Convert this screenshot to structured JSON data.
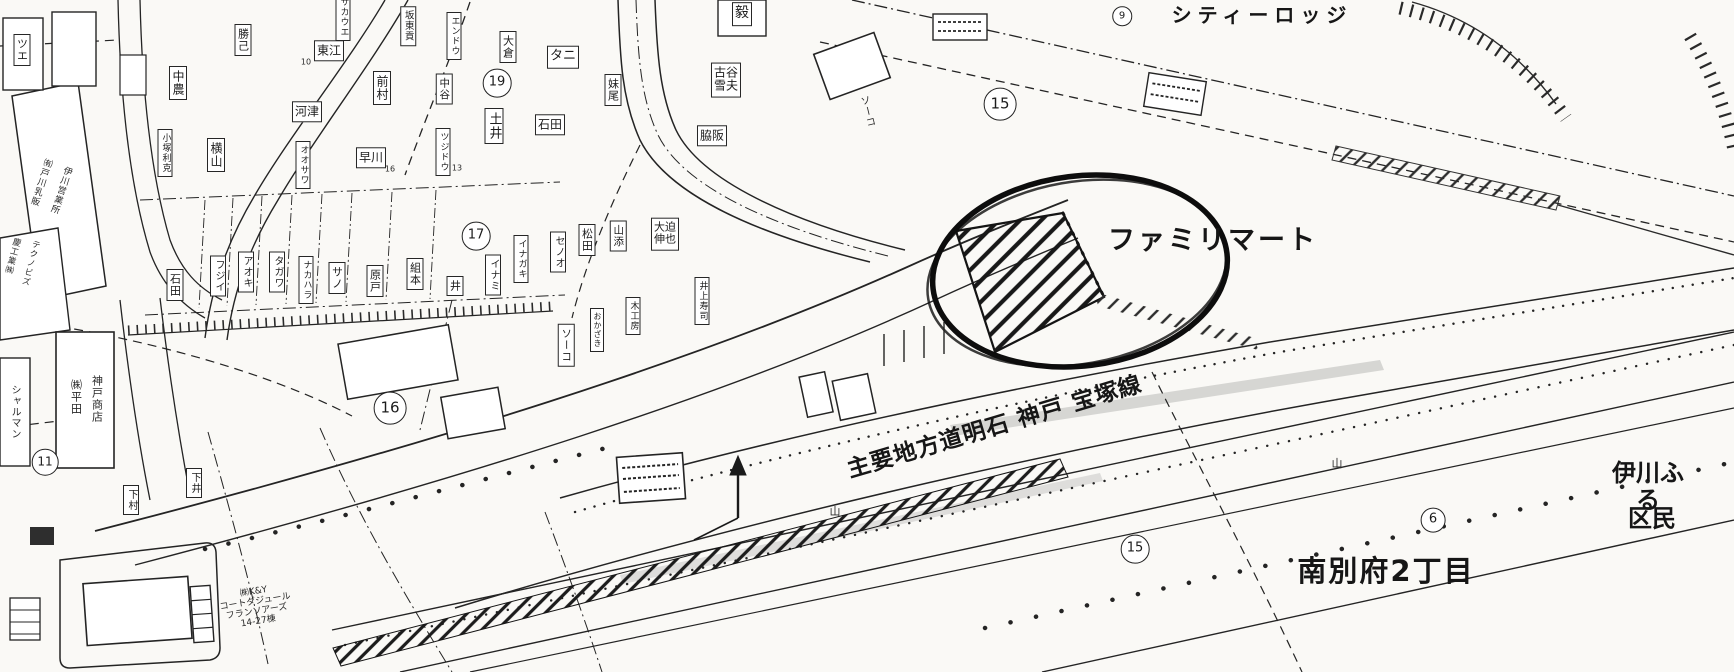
{
  "map": {
    "highlighted_store": "ファミリマート",
    "road_name": "主要地方道明石 神戸 宝塚線",
    "district": "南別府2丁目",
    "ink_color": "#242424",
    "paper_color": "#faf9f6",
    "labels": [
      {
        "t": "ファミリマート",
        "x": 1213,
        "y": 241,
        "k": "a",
        "s": 27,
        "ls": 3,
        "n": "familymart-label"
      },
      {
        "t": "主要地方道明石 神戸 宝塚線",
        "x": 995,
        "y": 428,
        "k": "a",
        "s": 23,
        "r": -16.5,
        "ls": 1,
        "n": "road-name-label"
      },
      {
        "t": "南別府2丁目",
        "x": 1386,
        "y": 571,
        "k": "a",
        "s": 29,
        "ls": 2,
        "n": "district-label"
      },
      {
        "t": "シティーロッジ",
        "x": 1262,
        "y": 15,
        "k": "a",
        "s": 20,
        "ls": 6,
        "n": "city-lodge-label"
      },
      {
        "t": "伊川ふる",
        "x": 1648,
        "y": 487,
        "k": "a",
        "s": 24,
        "n": "ikawa-furusato-label"
      },
      {
        "t": "区民",
        "x": 1652,
        "y": 519,
        "k": "a",
        "s": 24,
        "n": "kumin-label"
      },
      {
        "t": "19",
        "x": 497,
        "y": 83,
        "k": "c",
        "s": 13
      },
      {
        "t": "17",
        "x": 476,
        "y": 236,
        "k": "c",
        "s": 13
      },
      {
        "t": "16",
        "x": 390,
        "y": 408,
        "k": "c",
        "s": 15
      },
      {
        "t": "15",
        "x": 1000,
        "y": 104,
        "k": "c",
        "s": 15
      },
      {
        "t": "15",
        "x": 1135,
        "y": 549,
        "k": "c",
        "s": 13
      },
      {
        "t": "11",
        "x": 45,
        "y": 462,
        "k": "c",
        "s": 12
      },
      {
        "t": "6",
        "x": 1433,
        "y": 520,
        "k": "c",
        "s": 13
      },
      {
        "t": "9",
        "x": 1122,
        "y": 16,
        "k": "c",
        "s": 10
      },
      {
        "t": "中農",
        "x": 178,
        "y": 83,
        "k": "b",
        "m": "v",
        "s": 12
      },
      {
        "t": "勝己",
        "x": 243,
        "y": 40,
        "k": "b",
        "m": "v",
        "s": 11
      },
      {
        "t": "横山",
        "x": 216,
        "y": 155,
        "k": "b",
        "m": "v",
        "s": 12
      },
      {
        "t": "小塚利克",
        "x": 165,
        "y": 153,
        "k": "b",
        "m": "v",
        "s": 9
      },
      {
        "t": "河津",
        "x": 307,
        "y": 112,
        "k": "b",
        "s": 12
      },
      {
        "t": "オオサワ",
        "x": 303,
        "y": 165,
        "k": "b",
        "m": "v",
        "s": 9
      },
      {
        "t": "早川",
        "x": 371,
        "y": 158,
        "k": "b",
        "s": 12
      },
      {
        "t": "前村",
        "x": 382,
        "y": 88,
        "k": "b",
        "m": "v",
        "s": 12
      },
      {
        "t": "東江",
        "x": 329,
        "y": 51,
        "k": "b",
        "s": 12
      },
      {
        "t": "サカウエ",
        "x": 343,
        "y": 17,
        "k": "b",
        "m": "v",
        "s": 9
      },
      {
        "t": "坂東貢",
        "x": 408,
        "y": 26,
        "k": "b",
        "m": "v",
        "s": 9.5
      },
      {
        "t": "エンドウ",
        "x": 454,
        "y": 36,
        "k": "b",
        "m": "v",
        "s": 9
      },
      {
        "t": "中谷",
        "x": 444,
        "y": 89,
        "k": "b",
        "m": "v",
        "s": 10.5
      },
      {
        "t": "大倉",
        "x": 508,
        "y": 47,
        "k": "b",
        "m": "v",
        "s": 11
      },
      {
        "t": "タニ",
        "x": 563,
        "y": 57,
        "k": "b",
        "s": 13
      },
      {
        "t": "妹尾",
        "x": 613,
        "y": 90,
        "k": "b",
        "m": "v",
        "s": 11
      },
      {
        "t": "土井",
        "x": 494,
        "y": 126,
        "k": "b",
        "m": "v",
        "s": 13
      },
      {
        "t": "石田",
        "x": 550,
        "y": 125,
        "k": "b",
        "s": 12
      },
      {
        "t": "ツジドウ",
        "x": 443,
        "y": 152,
        "k": "b",
        "m": "v",
        "s": 9
      },
      {
        "t": "古谷\n雪夫",
        "x": 726,
        "y": 80,
        "k": "b",
        "s": 12
      },
      {
        "t": "脇阪",
        "x": 712,
        "y": 136,
        "k": "b",
        "s": 12
      },
      {
        "t": "石田",
        "x": 175,
        "y": 285,
        "k": "b",
        "m": "v",
        "s": 11
      },
      {
        "t": "フジイ",
        "x": 218,
        "y": 276,
        "k": "b",
        "m": "v",
        "s": 10
      },
      {
        "t": "アオキ",
        "x": 246,
        "y": 272,
        "k": "b",
        "m": "v",
        "s": 10
      },
      {
        "t": "タガワ",
        "x": 277,
        "y": 272,
        "k": "b",
        "m": "v",
        "s": 10
      },
      {
        "t": "ナカハラ",
        "x": 306,
        "y": 280,
        "k": "b",
        "m": "v",
        "s": 9
      },
      {
        "t": "サノ",
        "x": 337,
        "y": 278,
        "k": "b",
        "m": "v",
        "s": 11
      },
      {
        "t": "原戸",
        "x": 375,
        "y": 281,
        "k": "b",
        "m": "v",
        "s": 11
      },
      {
        "t": "組本",
        "x": 415,
        "y": 274,
        "k": "b",
        "m": "v",
        "s": 11
      },
      {
        "t": "井",
        "x": 455,
        "y": 286,
        "k": "b",
        "m": "v",
        "s": 11
      },
      {
        "t": "イナミ",
        "x": 493,
        "y": 275,
        "k": "b",
        "m": "v",
        "s": 10
      },
      {
        "t": "イナガキ",
        "x": 521,
        "y": 259,
        "k": "b",
        "m": "v",
        "s": 9
      },
      {
        "t": "セノオ",
        "x": 558,
        "y": 252,
        "k": "b",
        "m": "v",
        "s": 10
      },
      {
        "t": "松田",
        "x": 587,
        "y": 240,
        "k": "b",
        "m": "v",
        "s": 11
      },
      {
        "t": "山添",
        "x": 618,
        "y": 236,
        "k": "b",
        "m": "v",
        "s": 10.5
      },
      {
        "t": "大迫\n伸也",
        "x": 665,
        "y": 234,
        "k": "b",
        "s": 11
      },
      {
        "t": "井上寿司",
        "x": 702,
        "y": 301,
        "k": "b",
        "m": "v",
        "s": 9
      },
      {
        "t": "木工房",
        "x": 633,
        "y": 316,
        "k": "b",
        "m": "v",
        "s": 9
      },
      {
        "t": "ソーコ",
        "x": 566,
        "y": 345,
        "k": "b",
        "m": "v",
        "s": 10.5
      },
      {
        "t": "おかざき",
        "x": 597,
        "y": 330,
        "k": "b",
        "m": "v",
        "s": 8
      },
      {
        "t": "ソーコ",
        "x": 866,
        "y": 112,
        "k": "p",
        "m": "v",
        "s": 10,
        "r": -14
      },
      {
        "t": "㈱平田",
        "x": 76,
        "y": 397,
        "k": "p",
        "m": "v",
        "s": 11
      },
      {
        "t": "神戸商店",
        "x": 97,
        "y": 399,
        "k": "p",
        "m": "v",
        "s": 11
      },
      {
        "t": "シャルマン",
        "x": 14,
        "y": 412,
        "k": "p",
        "m": "v",
        "s": 10
      },
      {
        "t": "下村",
        "x": 131,
        "y": 500,
        "k": "b",
        "m": "v",
        "s": 10
      },
      {
        "t": "下井",
        "x": 194,
        "y": 483,
        "k": "b",
        "m": "v",
        "s": 10
      },
      {
        "t": "㈲戸川乳販",
        "x": 40,
        "y": 182,
        "k": "p",
        "m": "v",
        "s": 9,
        "r": 18
      },
      {
        "t": "伊川営業所",
        "x": 60,
        "y": 190,
        "k": "p",
        "m": "v",
        "s": 9,
        "r": 18
      },
      {
        "t": "慶工業㈱",
        "x": 12,
        "y": 256,
        "k": "p",
        "m": "v",
        "s": 8.5,
        "r": 15
      },
      {
        "t": "テクノビズ",
        "x": 30,
        "y": 263,
        "k": "p",
        "m": "v",
        "s": 8.5,
        "r": 15
      },
      {
        "t": "㈱K&Y\nコートダジュール\nフランソアーズ\n14-27棟",
        "x": 256,
        "y": 607,
        "k": "p",
        "s": 9,
        "r": -9
      },
      {
        "t": "ツエ",
        "x": 22,
        "y": 50,
        "k": "b",
        "m": "v",
        "s": 11
      },
      {
        "t": "毅",
        "x": 742,
        "y": 14,
        "k": "b",
        "s": 14
      },
      {
        "t": "山",
        "x": 835,
        "y": 512,
        "k": "p",
        "s": 11
      },
      {
        "t": "山",
        "x": 1337,
        "y": 464,
        "k": "p",
        "s": 11
      },
      {
        "t": "13",
        "x": 457,
        "y": 169,
        "k": "p",
        "s": 8
      },
      {
        "t": "10",
        "x": 306,
        "y": 63,
        "k": "p",
        "s": 8
      },
      {
        "t": "16",
        "x": 390,
        "y": 170,
        "k": "p",
        "s": 8
      }
    ]
  }
}
